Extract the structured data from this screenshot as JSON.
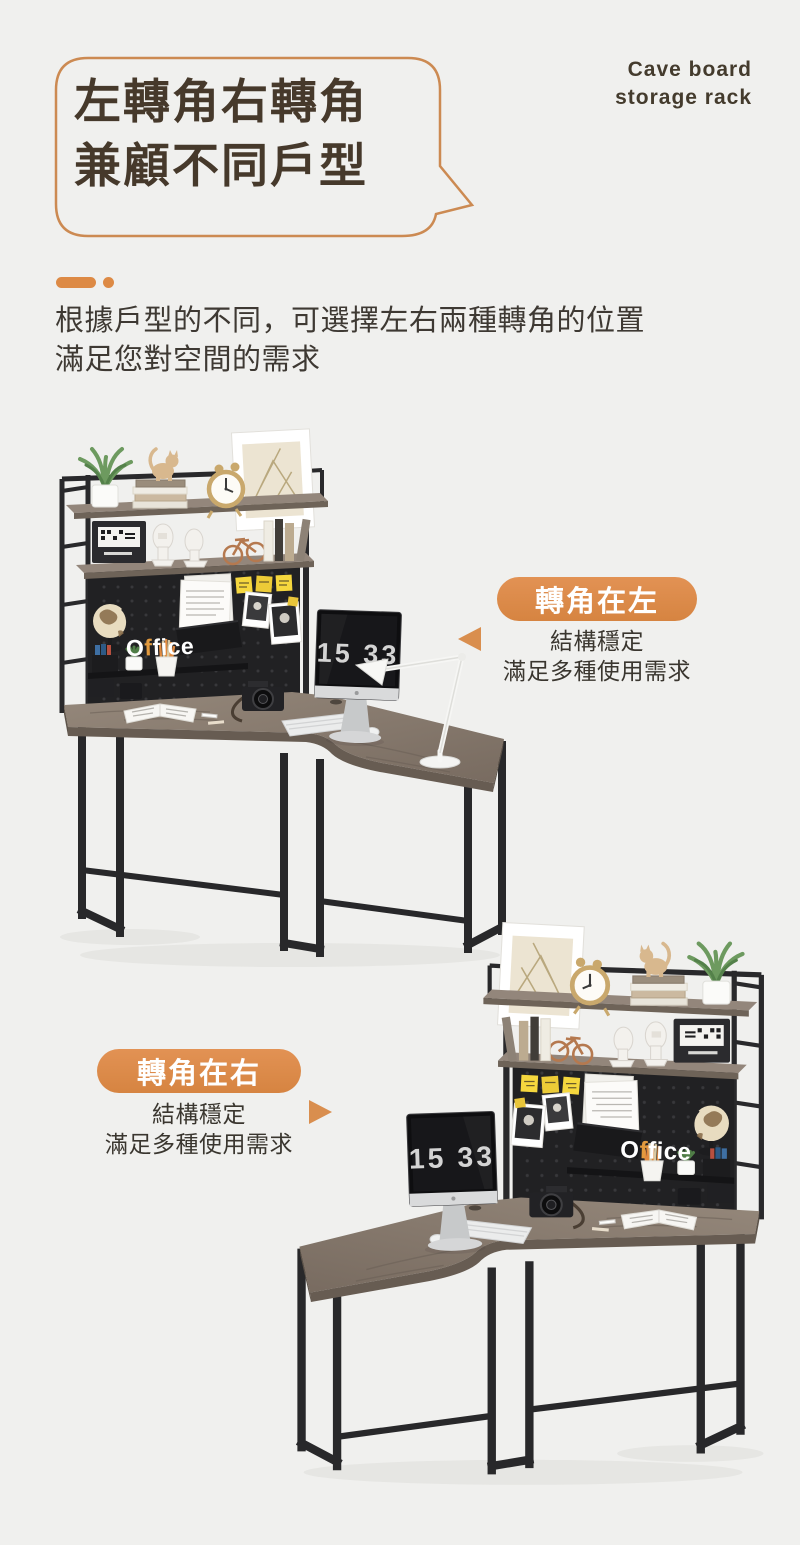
{
  "meta": {
    "width": 800,
    "height": 1545,
    "background": "#F0F0EE"
  },
  "header": {
    "bubble": {
      "line1": "左轉角右轉角",
      "line2": "兼顧不同戶型",
      "border_color": "#CC8A52",
      "text_color": "#46392B"
    },
    "tagline": {
      "line1": "Cave board",
      "line2": "storage rack",
      "color": "#443B2D"
    },
    "divider_color": "#DD8A45"
  },
  "intro": {
    "line1": "根據戶型的不同，可選擇左右兩種轉角的位置",
    "line2": "滿足您對空間的需求",
    "color": "#3E3933"
  },
  "sections": [
    {
      "id": "corner-left",
      "badge": "轉角在左",
      "desc_line1": "結構穩定",
      "desc_line2": "滿足多種使用需求",
      "arrow": "left",
      "illustration": {
        "monitor_time": "15 33",
        "word": {
          "p1": "O",
          "p2": "f",
          "p3": "fice"
        }
      }
    },
    {
      "id": "corner-right",
      "badge": "轉角在右",
      "desc_line1": "結構穩定",
      "desc_line2": "滿足多種使用需求",
      "arrow": "right",
      "illustration": {
        "monitor_time": "15 33",
        "word": {
          "p1": "O",
          "p2": "f",
          "p3": "fice"
        }
      }
    }
  ],
  "palette": {
    "accent": "#DB8A47",
    "accent_light": "#E29254",
    "bubble_border": "#CC8A52",
    "title_brown": "#46392B",
    "body_text": "#3E3933",
    "badge_text": "#FFFFFF",
    "wood": "#8D8076",
    "wood_dark": "#675C52",
    "metal_frame": "#29292B",
    "pegboard": "#212123",
    "sticky_note": "#F5D73E",
    "clock_digits": "#D4D4D4"
  }
}
